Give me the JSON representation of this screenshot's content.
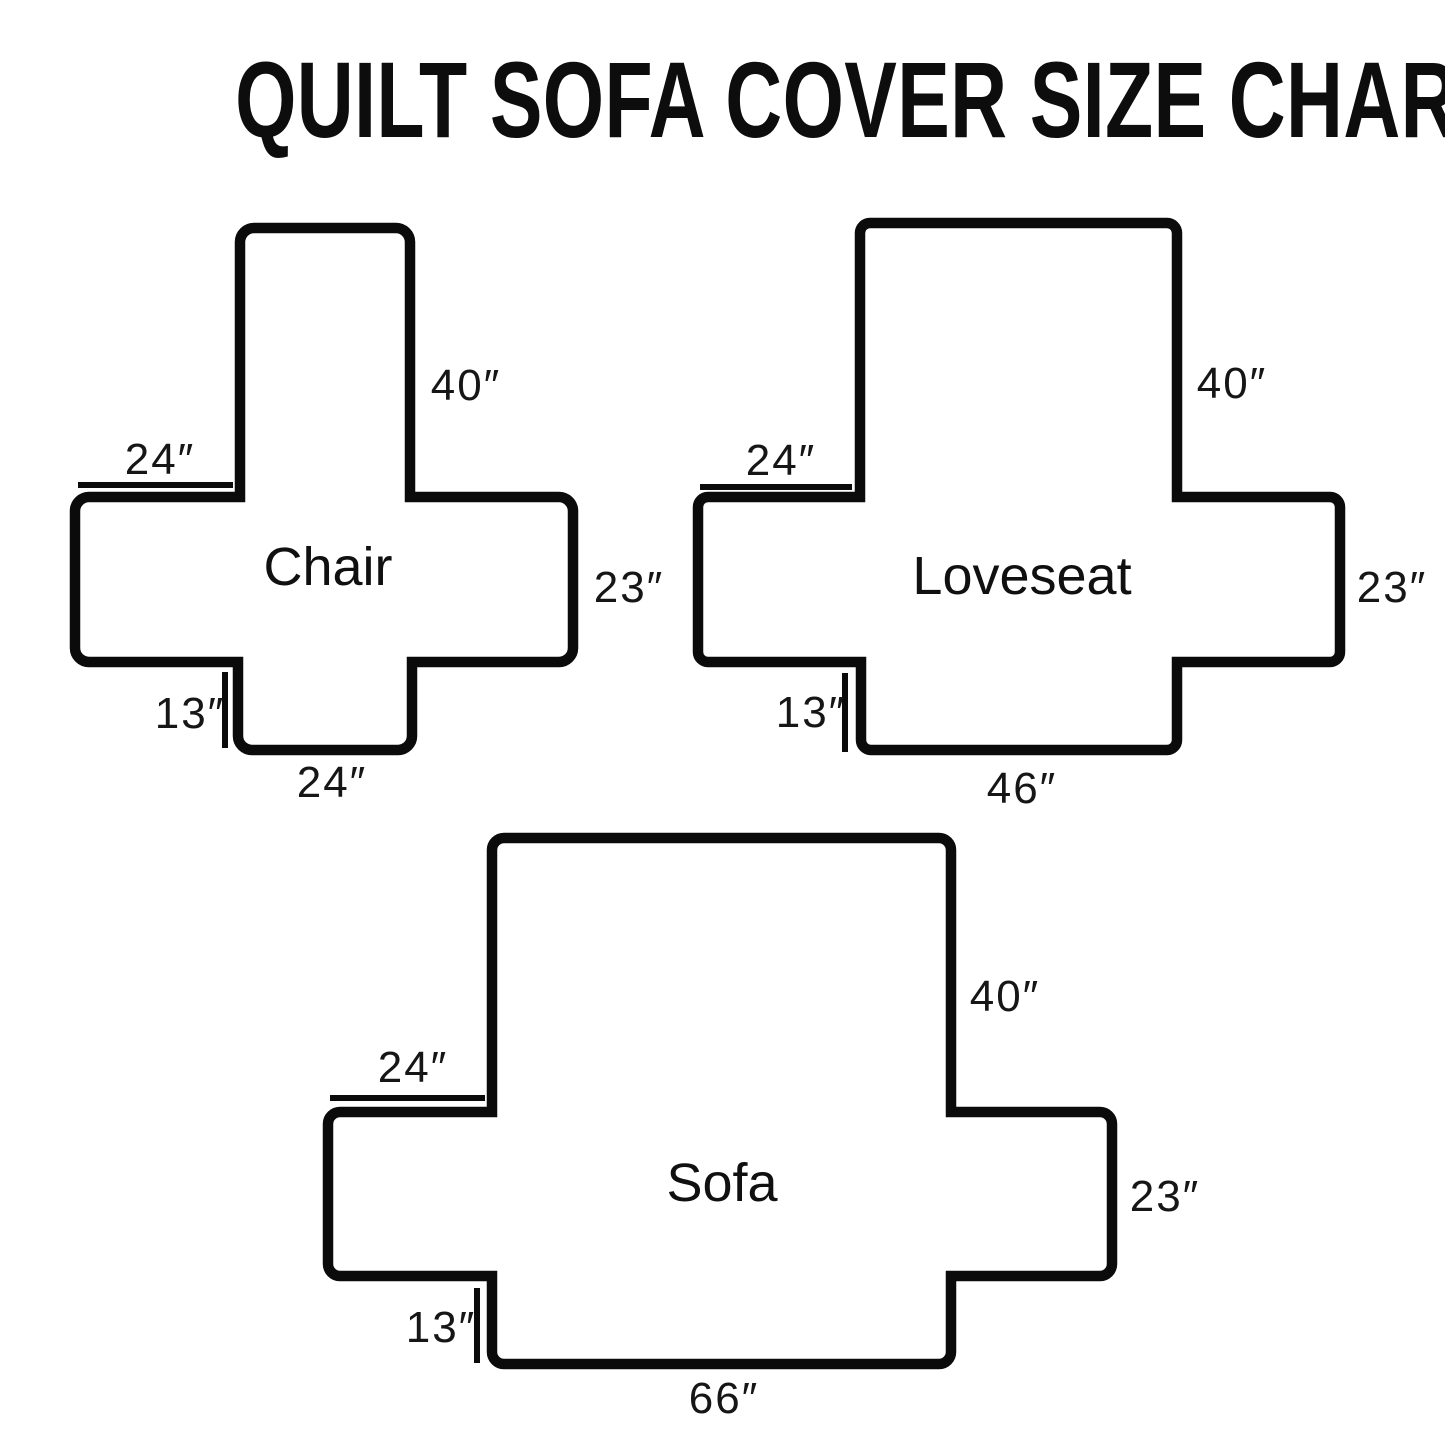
{
  "page": {
    "title": "QUILT SOFA COVER SIZE CHART",
    "background_color": "#ffffff",
    "line_color": "#0b0b0b",
    "text_color": "#161616"
  },
  "diagrams": [
    {
      "id": "chair",
      "label": "Chair",
      "back_height": "40″",
      "arm_top_width": "24″",
      "side_height": "23″",
      "front_drop": "13″",
      "seat_bottom_width": "24″"
    },
    {
      "id": "loveseat",
      "label": "Loveseat",
      "back_height": "40″",
      "arm_top_width": "24″",
      "side_height": "23″",
      "front_drop": "13″",
      "seat_bottom_width": "46″"
    },
    {
      "id": "sofa",
      "label": "Sofa",
      "back_height": "40″",
      "arm_top_width": "24″",
      "side_height": "23″",
      "front_drop": "13″",
      "seat_bottom_width": "66″"
    }
  ]
}
